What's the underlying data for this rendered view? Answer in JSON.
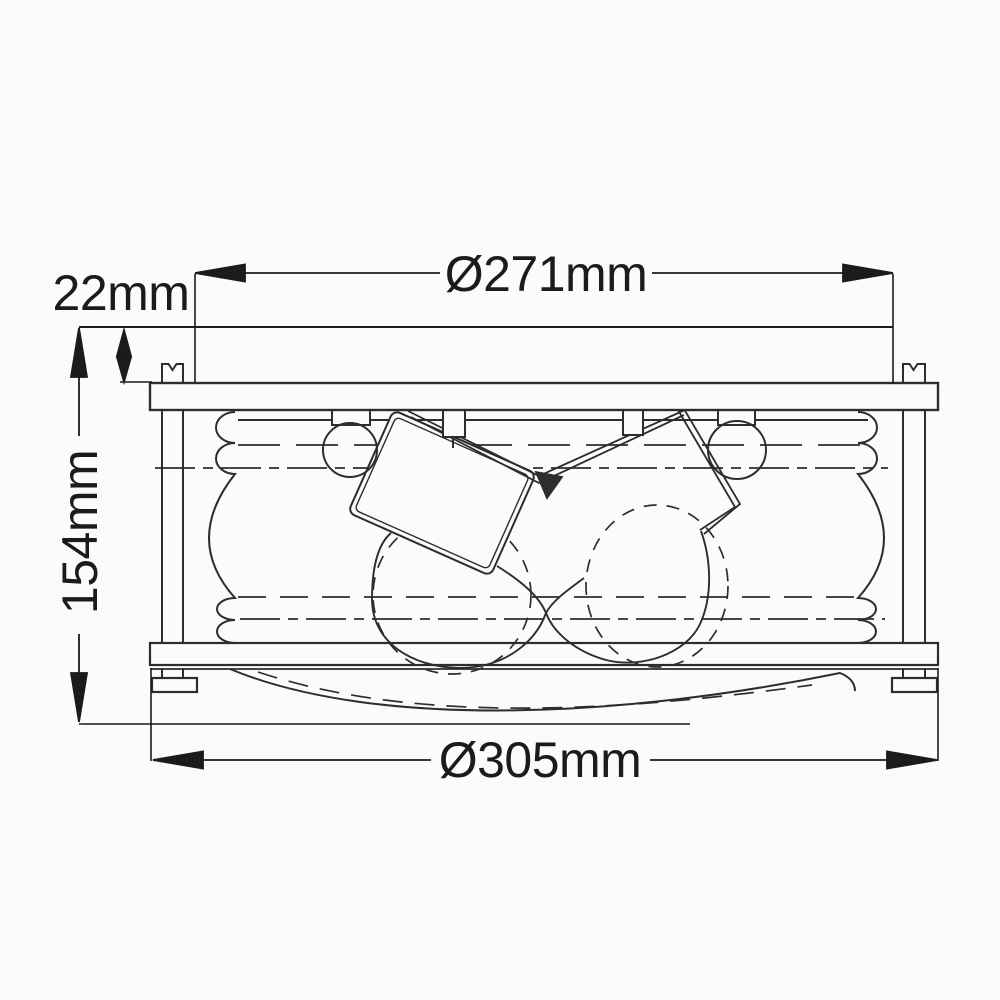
{
  "drawing": {
    "kind": "technical-dimension-drawing",
    "subject": "flush-mount ceiling light fixture, side section view",
    "background": "#fbfbfb",
    "line_color": "#2d2d2d",
    "text_color": "#1b1b1b",
    "dimensions": {
      "top_diameter": "Ø271mm",
      "canopy_height": "22mm",
      "overall_height": "154mm",
      "bottom_diameter": "Ø305mm"
    }
  }
}
